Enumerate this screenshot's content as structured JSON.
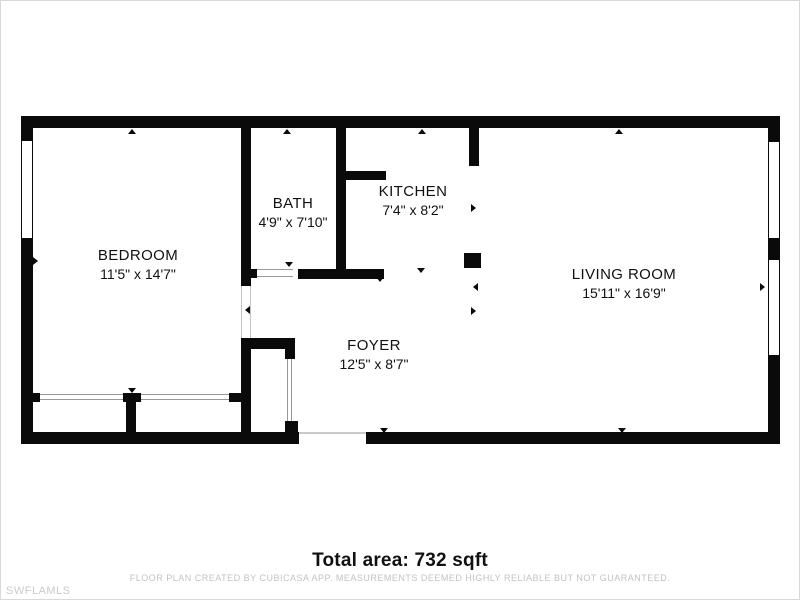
{
  "floor_plan": {
    "colors": {
      "wall": "#0a0a0a",
      "text": "#111111",
      "muted_text": "#c2c2c2",
      "watermark_color": "#cbcbcb",
      "background": "#ffffff",
      "frame": "#d9d9d9"
    },
    "rooms": [
      {
        "id": "bedroom",
        "name": "BEDROOM",
        "dimensions": "11'5\" x 14'7\""
      },
      {
        "id": "bath",
        "name": "BATH",
        "dimensions": "4'9\" x 7'10\""
      },
      {
        "id": "kitchen",
        "name": "KITCHEN",
        "dimensions": "7'4\" x 8'2\""
      },
      {
        "id": "living-room",
        "name": "LIVING ROOM",
        "dimensions": "15'11\" x 16'9\""
      },
      {
        "id": "foyer",
        "name": "FOYER",
        "dimensions": "12'5\" x 8'7\""
      }
    ],
    "total_area": "Total area: 732 sqft",
    "disclaimer": "FLOOR PLAN CREATED BY CUBICASA APP. MEASUREMENTS DEEMED HIGHLY RELIABLE BUT NOT GUARANTEED.",
    "watermark": "SWFLAMLS"
  }
}
